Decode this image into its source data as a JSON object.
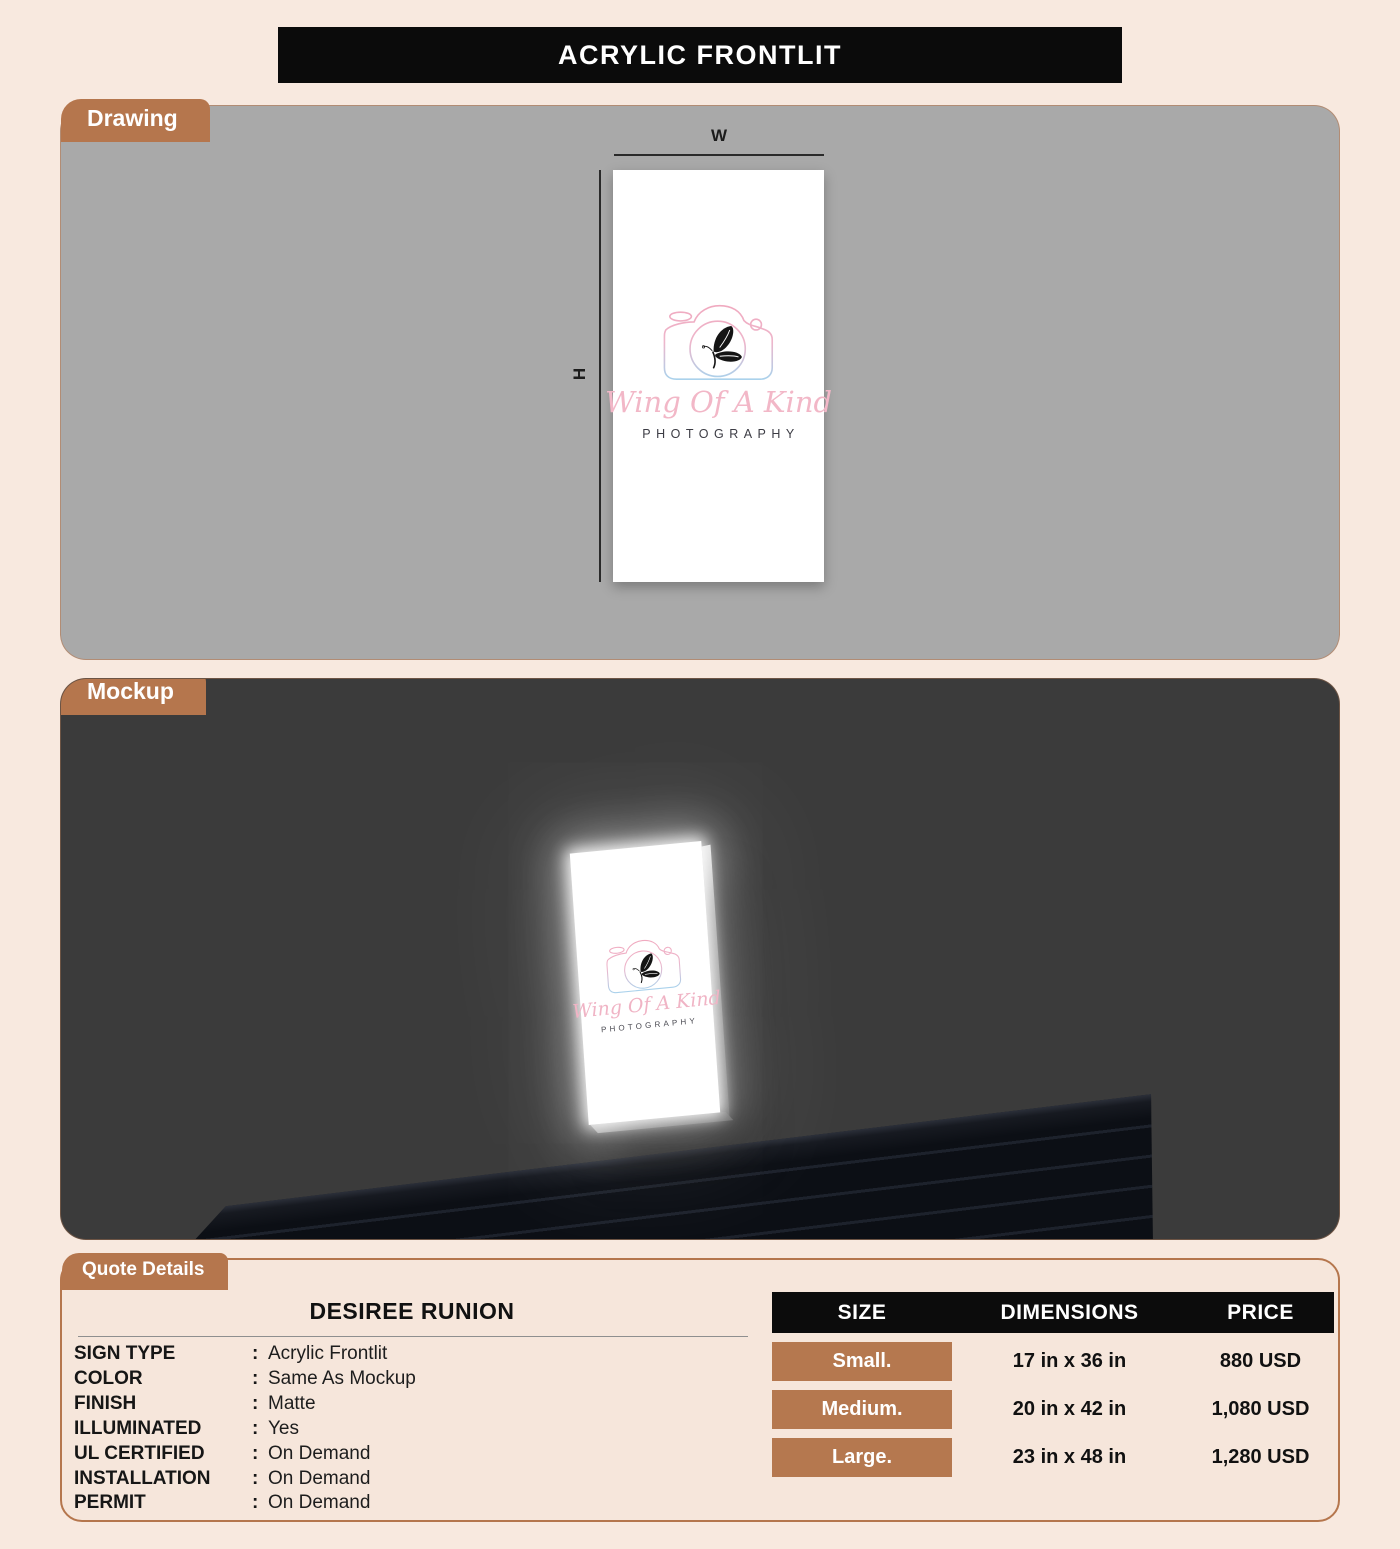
{
  "title_bar": {
    "title": "ACRYLIC FRONTLIT"
  },
  "drawing": {
    "label": "Drawing",
    "width_label": "W",
    "height_label": "H"
  },
  "mockup": {
    "label": "Mockup"
  },
  "logo": {
    "script_text": "Wing Of A Kind",
    "subtext": "PHOTOGRAPHY"
  },
  "quote": {
    "label": "Quote Details",
    "customer_name": "DESIREE RUNION",
    "colon": ":",
    "details": [
      {
        "label": "SIGN TYPE",
        "value": "Acrylic Frontlit"
      },
      {
        "label": "COLOR",
        "value": "Same As Mockup"
      },
      {
        "label": "FINISH",
        "value": "Matte"
      },
      {
        "label": "ILLUMINATED",
        "value": "Yes"
      },
      {
        "label": "UL CERTIFIED",
        "value": "On Demand"
      },
      {
        "label": "INSTALLATION",
        "value": "On Demand"
      },
      {
        "label": "PERMIT",
        "value": "On Demand"
      }
    ]
  },
  "pricing": {
    "headers": [
      "SIZE",
      "DIMENSIONS",
      "PRICE"
    ],
    "rows": [
      {
        "size": "Small.",
        "dimensions": "17 in x 36 in",
        "price": "880 USD"
      },
      {
        "size": "Medium.",
        "dimensions": "20 in x 42 in",
        "price": "1,080 USD"
      },
      {
        "size": "Large.",
        "dimensions": "23 in x 48 in",
        "price": "1,280 USD"
      }
    ]
  },
  "colors": {
    "accent": "#b5764d",
    "page_background": "#f8e9df",
    "drawing_background": "#a9a9a9",
    "mockup_background": "#3b3b3b",
    "table_header_background": "#0c0c0c",
    "logo_pink": "#f0a9bf",
    "logo_blue": "#a9d2ec"
  }
}
